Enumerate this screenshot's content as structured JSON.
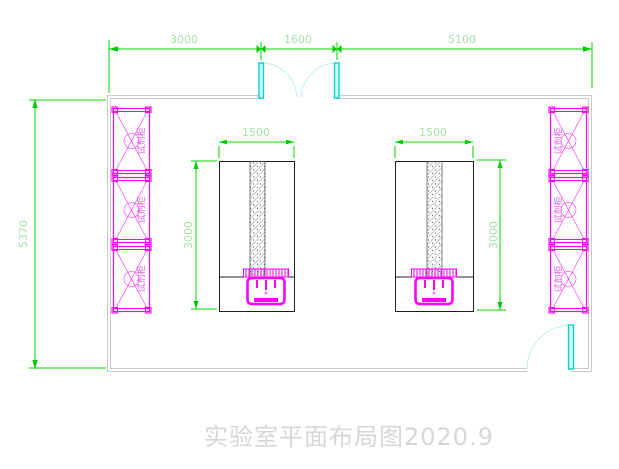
{
  "drawing": {
    "title": "实验室平面布局图2020.9",
    "dimensions": {
      "top_left": "3000",
      "top_middle": "1600",
      "top_right": "5100",
      "left_height": "5370",
      "bench_width_left": "1500",
      "bench_width_right": "1500",
      "bench_depth_left": "3000",
      "bench_depth_right": "3000"
    },
    "cabinet_label": "试剂柜",
    "colors": {
      "dimension_line": "#00d500",
      "dimension_text": "#a7e2a7",
      "cabinet": "#ff00ff",
      "door": "#00d2d2",
      "wall": "#c9c9c9",
      "bench": "#1f1f1f",
      "title_text": "#d7d7d7"
    }
  }
}
